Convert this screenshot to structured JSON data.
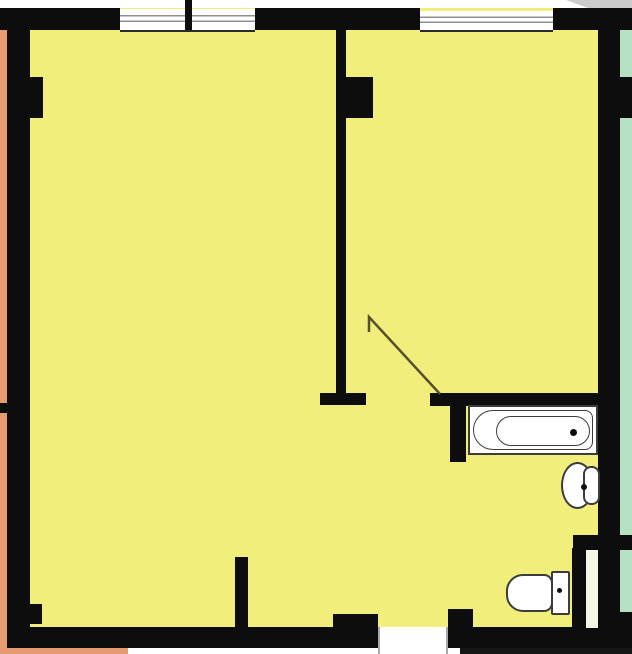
{
  "title": "apartment-floor-plan",
  "colors": {
    "floor": "#f2ee7c",
    "wall": "#0d0d0d",
    "neighbor_left": "#e49b72",
    "neighbor_right": "#b6e2c3",
    "white": "#ffffff",
    "fixture_border": "#3c3c3c",
    "window_line": "#8f8f8f",
    "window_edge": "#2a2a2a",
    "corner_gray": "#cbcbcb",
    "door_leaf": "#55512c",
    "shaft": "#f6f6e8",
    "bottom_dark": "#161616",
    "frame_gray": "#a9a9a9"
  },
  "plan": {
    "type": "floor-plan",
    "rooms": [
      "room-left",
      "room-right",
      "bathroom",
      "wc-area"
    ],
    "windows": [
      {
        "name": "window-top-left",
        "panes": 2
      },
      {
        "name": "window-top-right",
        "panes": 1
      }
    ],
    "doors": [
      {
        "name": "interior-door",
        "state": "open, swing arc leaf shown"
      },
      {
        "name": "entrance-door-opening",
        "state": "gap in bottom wall"
      }
    ],
    "fixtures": [
      {
        "name": "bathtub",
        "location": "bathroom"
      },
      {
        "name": "sink",
        "location": "bathroom"
      },
      {
        "name": "toilet",
        "location": "wc-area"
      }
    ],
    "adjacent_structures": [
      {
        "name": "neighbor-left",
        "color": "#e49b72"
      },
      {
        "name": "neighbor-right",
        "color": "#b6e2c3"
      }
    ]
  }
}
